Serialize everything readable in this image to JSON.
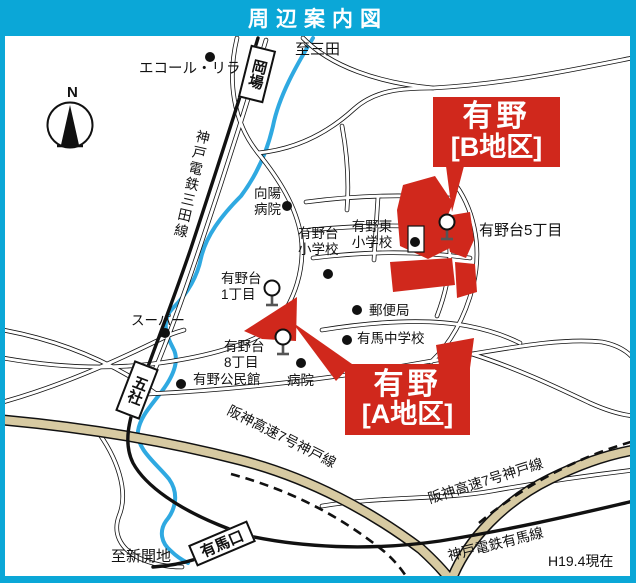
{
  "header": {
    "title": "周辺案内図"
  },
  "colors": {
    "frame_cyan": "#0BA7D7",
    "accent_red": "#D0281C",
    "highway_tan": "#D7CAA2",
    "river_blue": "#2FA9E1",
    "map_bg": "#FFFFFF",
    "line_black": "#111111"
  },
  "compass": {
    "north": "N"
  },
  "areas": {
    "district_b": {
      "line1": "有野",
      "line2": "[B地区]"
    },
    "district_a": {
      "line1": "有野",
      "line2": "[A地区]"
    }
  },
  "stations": {
    "okaba": "岡場",
    "gosha": "五社",
    "arimaguchi": "有馬口"
  },
  "rail_lines": {
    "sanda_line": "神戸電鉄三田線",
    "arima_line": "神戸電鉄有馬線"
  },
  "highways": {
    "hanshin_label_1": "阪神高速7号神戸線",
    "hanshin_label_2": "阪神高速7号神戸線"
  },
  "places": {
    "to_sanda": "至三田",
    "ecole_lila": "エコール・リラ",
    "koyo_hospital": "向陽\n病院",
    "arinodai_elementary": "有野台\n小学校",
    "arinohigashi_elementary": "有野東\n小学校",
    "arinodai_5chome": "有野台5丁目",
    "arinodai_1chome": "有野台\n1丁目",
    "post_office": "郵便局",
    "arima_junior_high": "有馬中学校",
    "supermarket": "スーパー",
    "arinodai_8chome": "有野台\n8丁目",
    "arino_community_hall": "有野公民館",
    "hospital": "病院",
    "to_shinkaichi": "至新開地",
    "as_of": "H19.4現在"
  }
}
